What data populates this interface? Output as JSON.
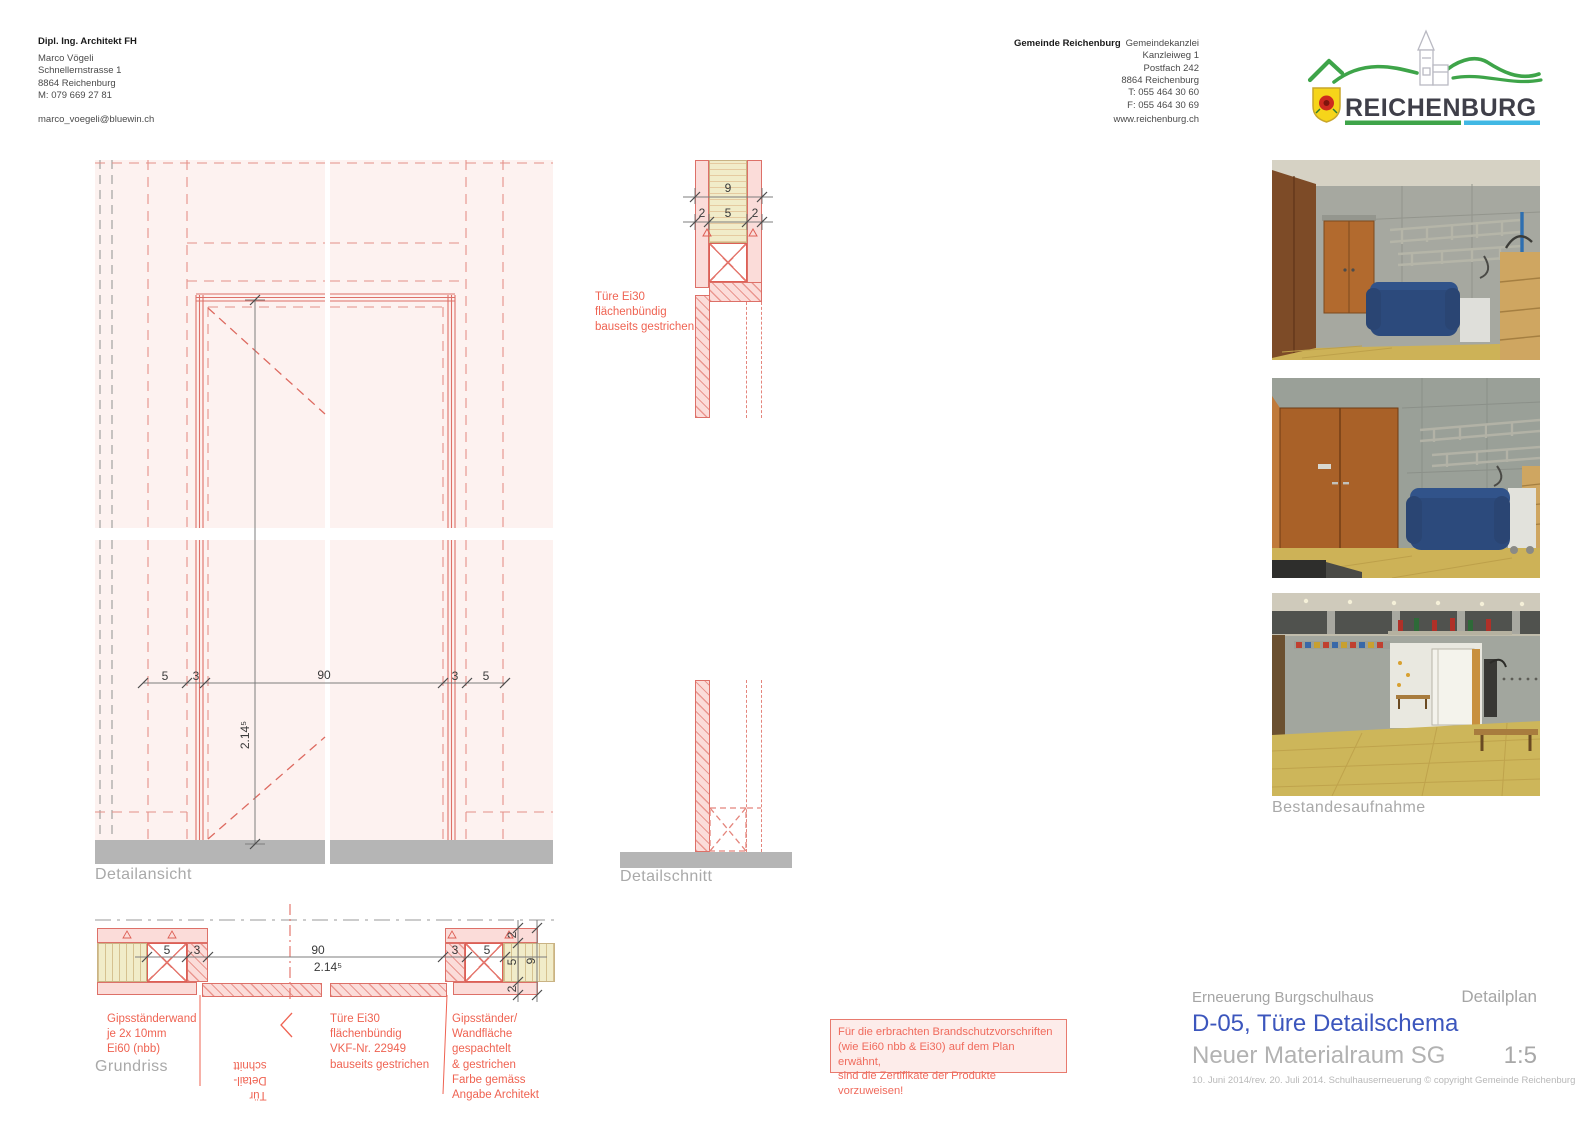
{
  "header": {
    "architect": {
      "title": "Dipl. Ing. Architekt FH",
      "address": "Marco Vögeli\nSchnellernstrasse 1\n8864 Reichenburg\nM: 079 669 27 81",
      "email": "marco_voegeli@bluewin.ch"
    },
    "municipality": {
      "name": "Gemeinde Reichenburg",
      "address": "Gemeindekanzlei\nKanzleiweg 1\nPostfach 242\n8864 Reichenburg\nT: 055 464 30 60\nF: 055 464 30 69",
      "website": "www.reichenburg.ch"
    },
    "logo": {
      "wordmark": "REICHENBURG"
    }
  },
  "elevation": {
    "label": "Detailansicht",
    "dims": {
      "w1": "5",
      "w2": "3",
      "w3": "90",
      "w4": "3",
      "w5": "5",
      "height": "2.14⁵"
    }
  },
  "section": {
    "label": "Detailschnitt",
    "dims": {
      "total": "9",
      "p1": "2",
      "p2": "5",
      "p3": "2"
    },
    "note": "Türe Ei30\nflächenbündig\nbauseits gestrichen"
  },
  "plan": {
    "label": "Grundriss",
    "dims": {
      "w1": "5",
      "w2": "3",
      "w3": "90",
      "w3b": "2.14⁵",
      "w4": "3",
      "w5": "5",
      "r1": "2",
      "r2": "5",
      "r3": "2",
      "rtotal": "9"
    },
    "notes": {
      "wall": "Gipsständerwand\nje 2x 10mm\nEi60 (nbb)",
      "cut": "Tür\nDetail-\nschnitt",
      "door": "Türe Ei30\nflächenbündig\nVKF-Nr. 22949\nbauseits gestrichen",
      "finish": "Gipsständer/\nWandfläche\ngespachtelt\n& gestrichen\nFarbe gemäss\nAngabe Architekt"
    }
  },
  "photos": {
    "label": "Bestandesaufnahme"
  },
  "notice": {
    "text": "Für die erbrachten Brandschutzvorschriften\n(wie Ei60 nbb & Ei30) auf dem Plan erwähnt,\nsind die Zertifikate der Produkte vorzuweisen!"
  },
  "titleblock": {
    "project": "Erneuerung Burgschulhaus",
    "type": "Detailplan",
    "title": "D-05, Türe Detailschema",
    "subtitle": "Neuer Materialraum SG",
    "scale": "1:5",
    "revision": "10. Juni 2014/rev. 20. Juli 2014. Schulhauserneuerung © copyright Gemeinde Reichenburg"
  },
  "colors": {
    "accent_red": "#ee6352",
    "line_salmon": "#dd7068",
    "title_blue": "#3c56bd",
    "logo_green": "#3ea449",
    "logo_cyan": "#41b8e4",
    "floor_gray": "#b5b5b5"
  }
}
